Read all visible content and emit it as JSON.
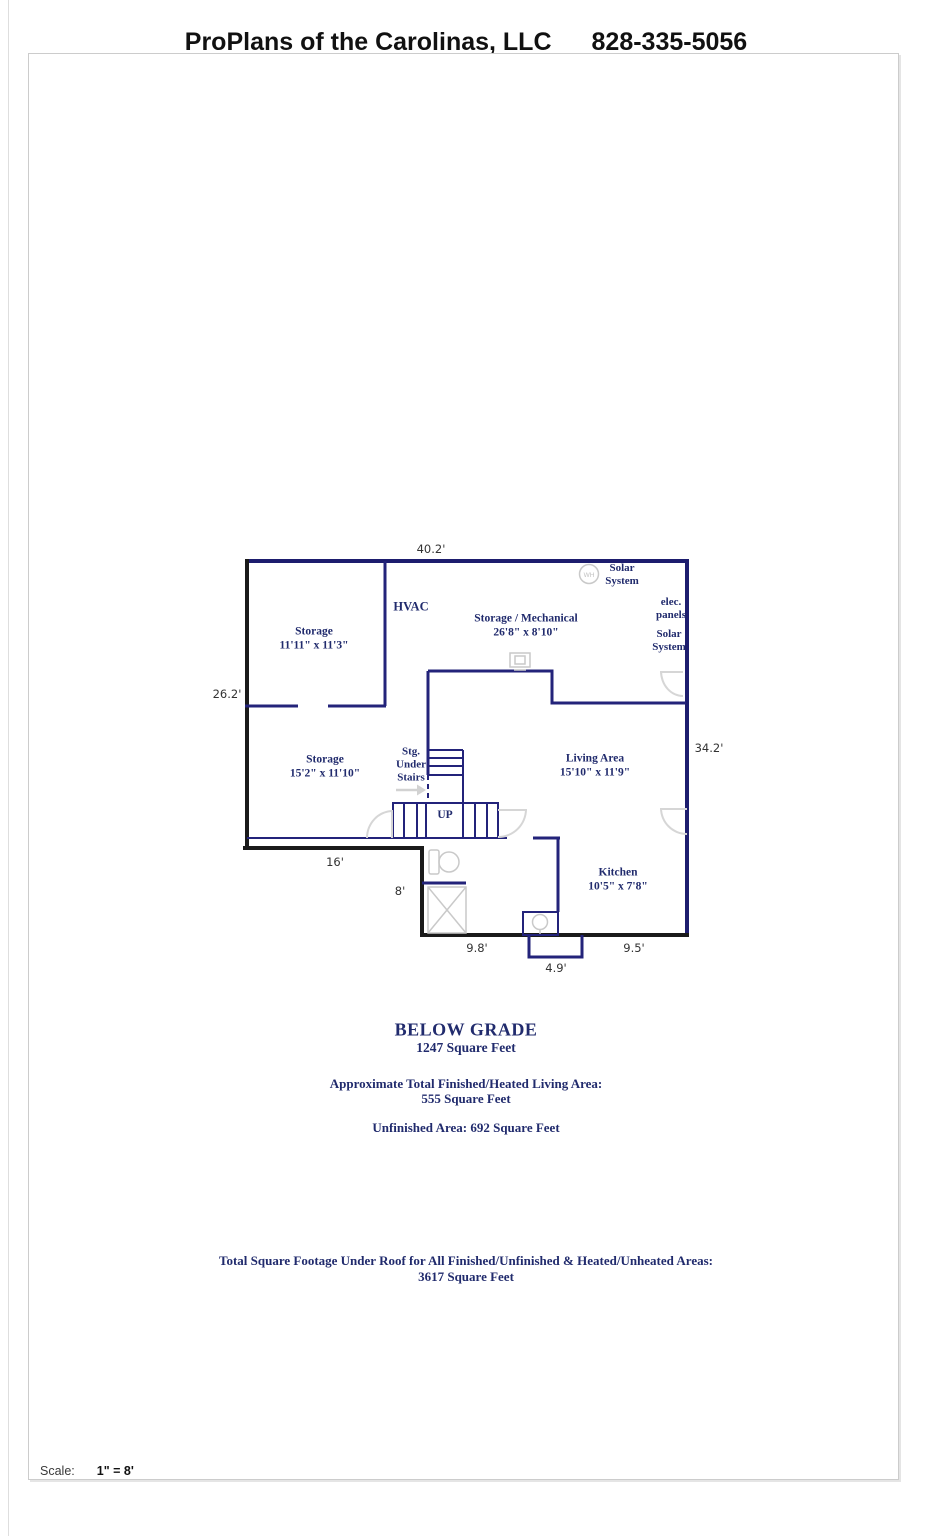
{
  "header": {
    "company": "ProPlans of the Carolinas, LLC",
    "phone": "828-335-5056"
  },
  "plan": {
    "rooms": {
      "storage_upper": {
        "name": "Storage",
        "dims": "11'11\" x 11'3\""
      },
      "hvac": {
        "name": "HVAC"
      },
      "storage_mech": {
        "name": "Storage / Mechanical",
        "dims": "26'8\" x 8'10\""
      },
      "solar_top": {
        "line1": "Solar",
        "line2": "System"
      },
      "elec_panels": {
        "line1": "elec.",
        "line2": "panels"
      },
      "solar_right": {
        "line1": "Solar",
        "line2": "System"
      },
      "storage_lower": {
        "name": "Storage",
        "dims": "15'2\" x 11'10\""
      },
      "stg_under_stairs": {
        "line1": "Stg.",
        "line2": "Under",
        "line3": "Stairs"
      },
      "up": {
        "name": "UP"
      },
      "living": {
        "name": "Living Area",
        "dims": "15'10\" x 11'9\""
      },
      "kitchen": {
        "name": "Kitchen",
        "dims": "10'5\" x 7'8\""
      },
      "water_heater": "WH"
    },
    "dimensions": {
      "top": "40.2'",
      "left": "26.2'",
      "right": "34.2'",
      "bottom_left": "16'",
      "mid_left": "8'",
      "bottom_bath": "9.8'",
      "bottom_bump": "4.9'",
      "bottom_kitchen": "9.5'"
    }
  },
  "summary": {
    "floor_name": "BELOW GRADE",
    "floor_area": "1247 Square Feet",
    "heated_label": "Approximate Total Finished/Heated Living Area:",
    "heated_area": "555 Square Feet",
    "unfinished": "Unfinished Area:  692 Square Feet",
    "total_label": "Total Square Footage Under Roof for All Finished/Unfinished & Heated/Unheated Areas:",
    "total_area": "3617 Square Feet"
  },
  "footer": {
    "scale_label": "Scale:",
    "scale_value": "1\" = 8'"
  },
  "colors": {
    "wall_navy": "#1d1d6e",
    "wall_black": "#1a1a1a",
    "label_navy": "#212b6d",
    "fixture_gray": "#c9c9c9",
    "dimension_gray": "#333333"
  }
}
